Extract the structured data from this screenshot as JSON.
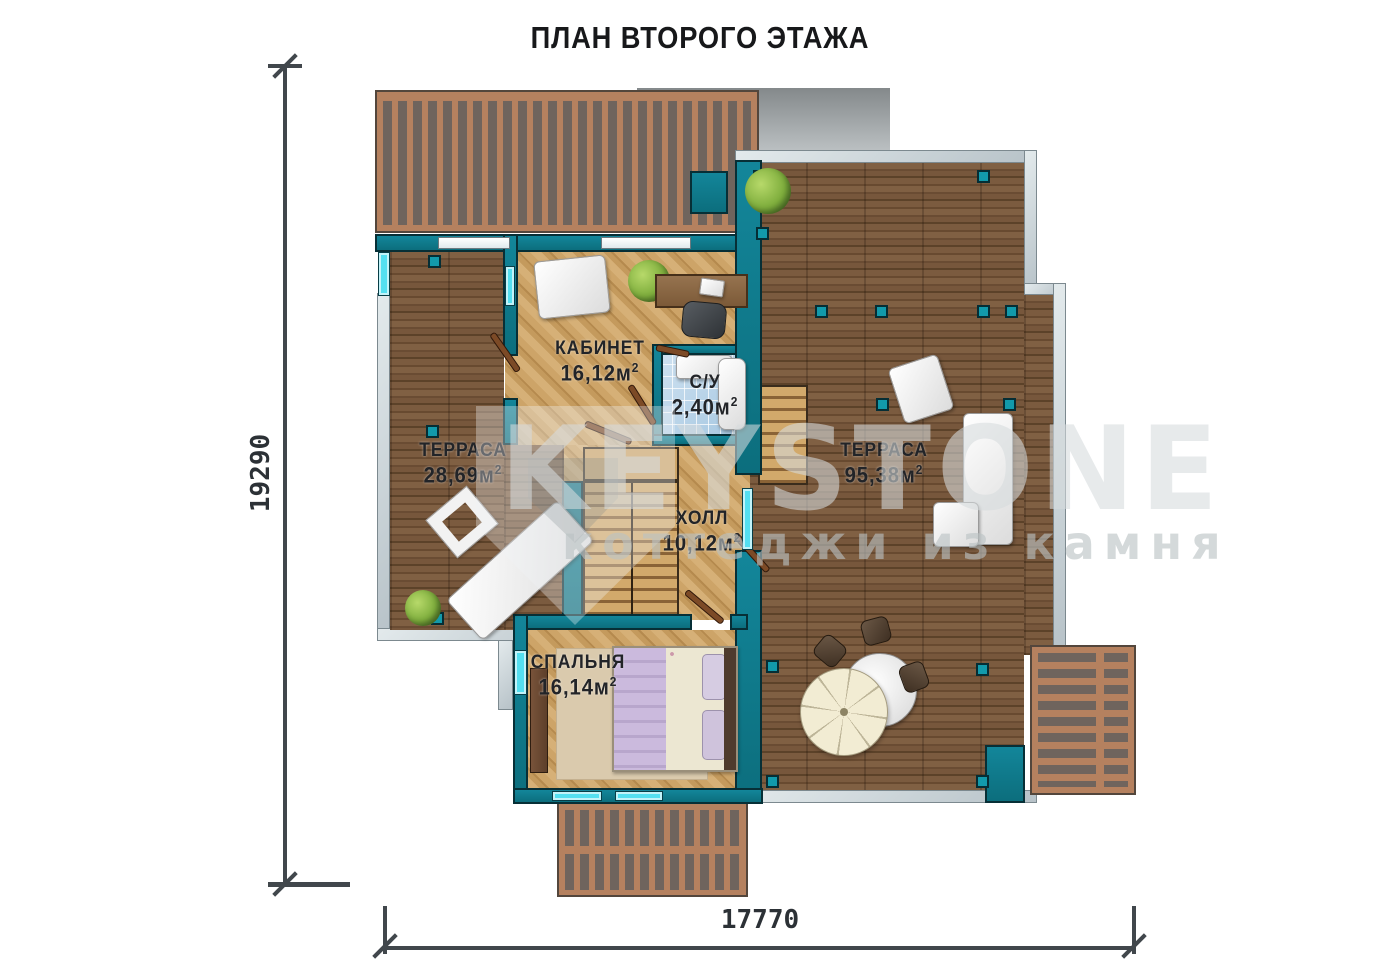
{
  "title": "ПЛАН ВТОРОГО ЭТАЖА",
  "watermark": {
    "brand": "KEYSTONE",
    "tagline": "коттеджи из камня"
  },
  "dimensions": {
    "height_mm": "19290",
    "width_mm": "17770"
  },
  "rooms": {
    "office": {
      "name": "КАБИНЕТ",
      "area": "16,12м",
      "sup": "2"
    },
    "bathroom": {
      "name": "С/У",
      "area": "2,40м",
      "sup": "2"
    },
    "terrace_left": {
      "name": "ТЕРРАСА",
      "area": "28,69м",
      "sup": "2"
    },
    "terrace_right": {
      "name": "ТЕРРАСА",
      "area": "95,38м",
      "sup": "2"
    },
    "hall": {
      "name": "ХОЛЛ",
      "area": "10,12м",
      "sup": "2"
    },
    "bedroom": {
      "name": "СПАЛЬНЯ",
      "area": "16,14м",
      "sup": "2"
    }
  },
  "colors": {
    "wall_teal": "#0f7e8e",
    "deck_wood": "#7a5a3e",
    "floor_wood": "#c9a468",
    "window_cyan": "#54dff0",
    "railing_gray": "#c9d3d7",
    "pergola_brown": "#b5815f",
    "dimension_line": "#41474c"
  }
}
